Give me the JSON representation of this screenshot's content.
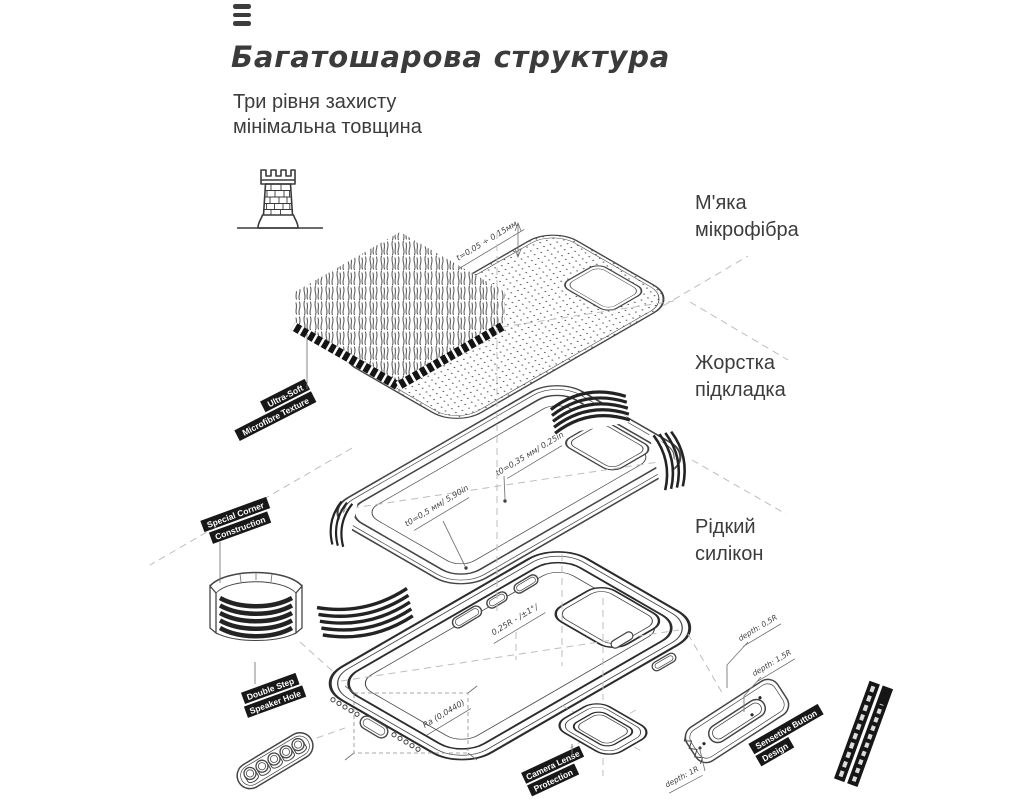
{
  "colors": {
    "background": "#ffffff",
    "text": "#3c3c3c",
    "line": "#454545",
    "label_bg": "#181818",
    "label_text": "#ffffff",
    "dash": "#bdbdbd"
  },
  "header": {
    "logo_icon": "three-bars-icon",
    "title": "Багатошарова структура",
    "subtitle_lines": [
      "Три рівня захисту",
      "мінімальна товщина"
    ]
  },
  "icons": {
    "tower": "castle-tower-icon"
  },
  "callouts": [
    {
      "lines": [
        "М'яка",
        "мікрофібра"
      ]
    },
    {
      "lines": [
        "Жорстка",
        "підкладка"
      ]
    },
    {
      "lines": [
        "Рідкий",
        "силікон"
      ]
    }
  ],
  "ribbons": [
    {
      "lines": [
        "Ultra-Soft",
        "Microfibre Texture"
      ]
    },
    {
      "lines": [
        "Special Corner",
        "Construction"
      ]
    },
    {
      "lines": [
        "Double Step",
        "Speaker Hole"
      ]
    },
    {
      "lines": [
        "Sensetive Button",
        "Design"
      ]
    },
    {
      "lines": [
        "Camera Lense",
        "Protection"
      ]
    }
  ],
  "annotations": {
    "sheet_thickness": "t=0,05 ÷ 0,15мм",
    "lining_thickness": "t0=0,35 мм/ 0,25in",
    "lining_thickness2": "t0=0,5 мм/ 5,90in",
    "case_radius": "0,25R - /±1°/",
    "case_roughness": "Ra (0,0440)",
    "depth_small": "depth: 0,5R",
    "depth_large": "depth: 1,5R",
    "depth_camera": "depth: 1R"
  }
}
